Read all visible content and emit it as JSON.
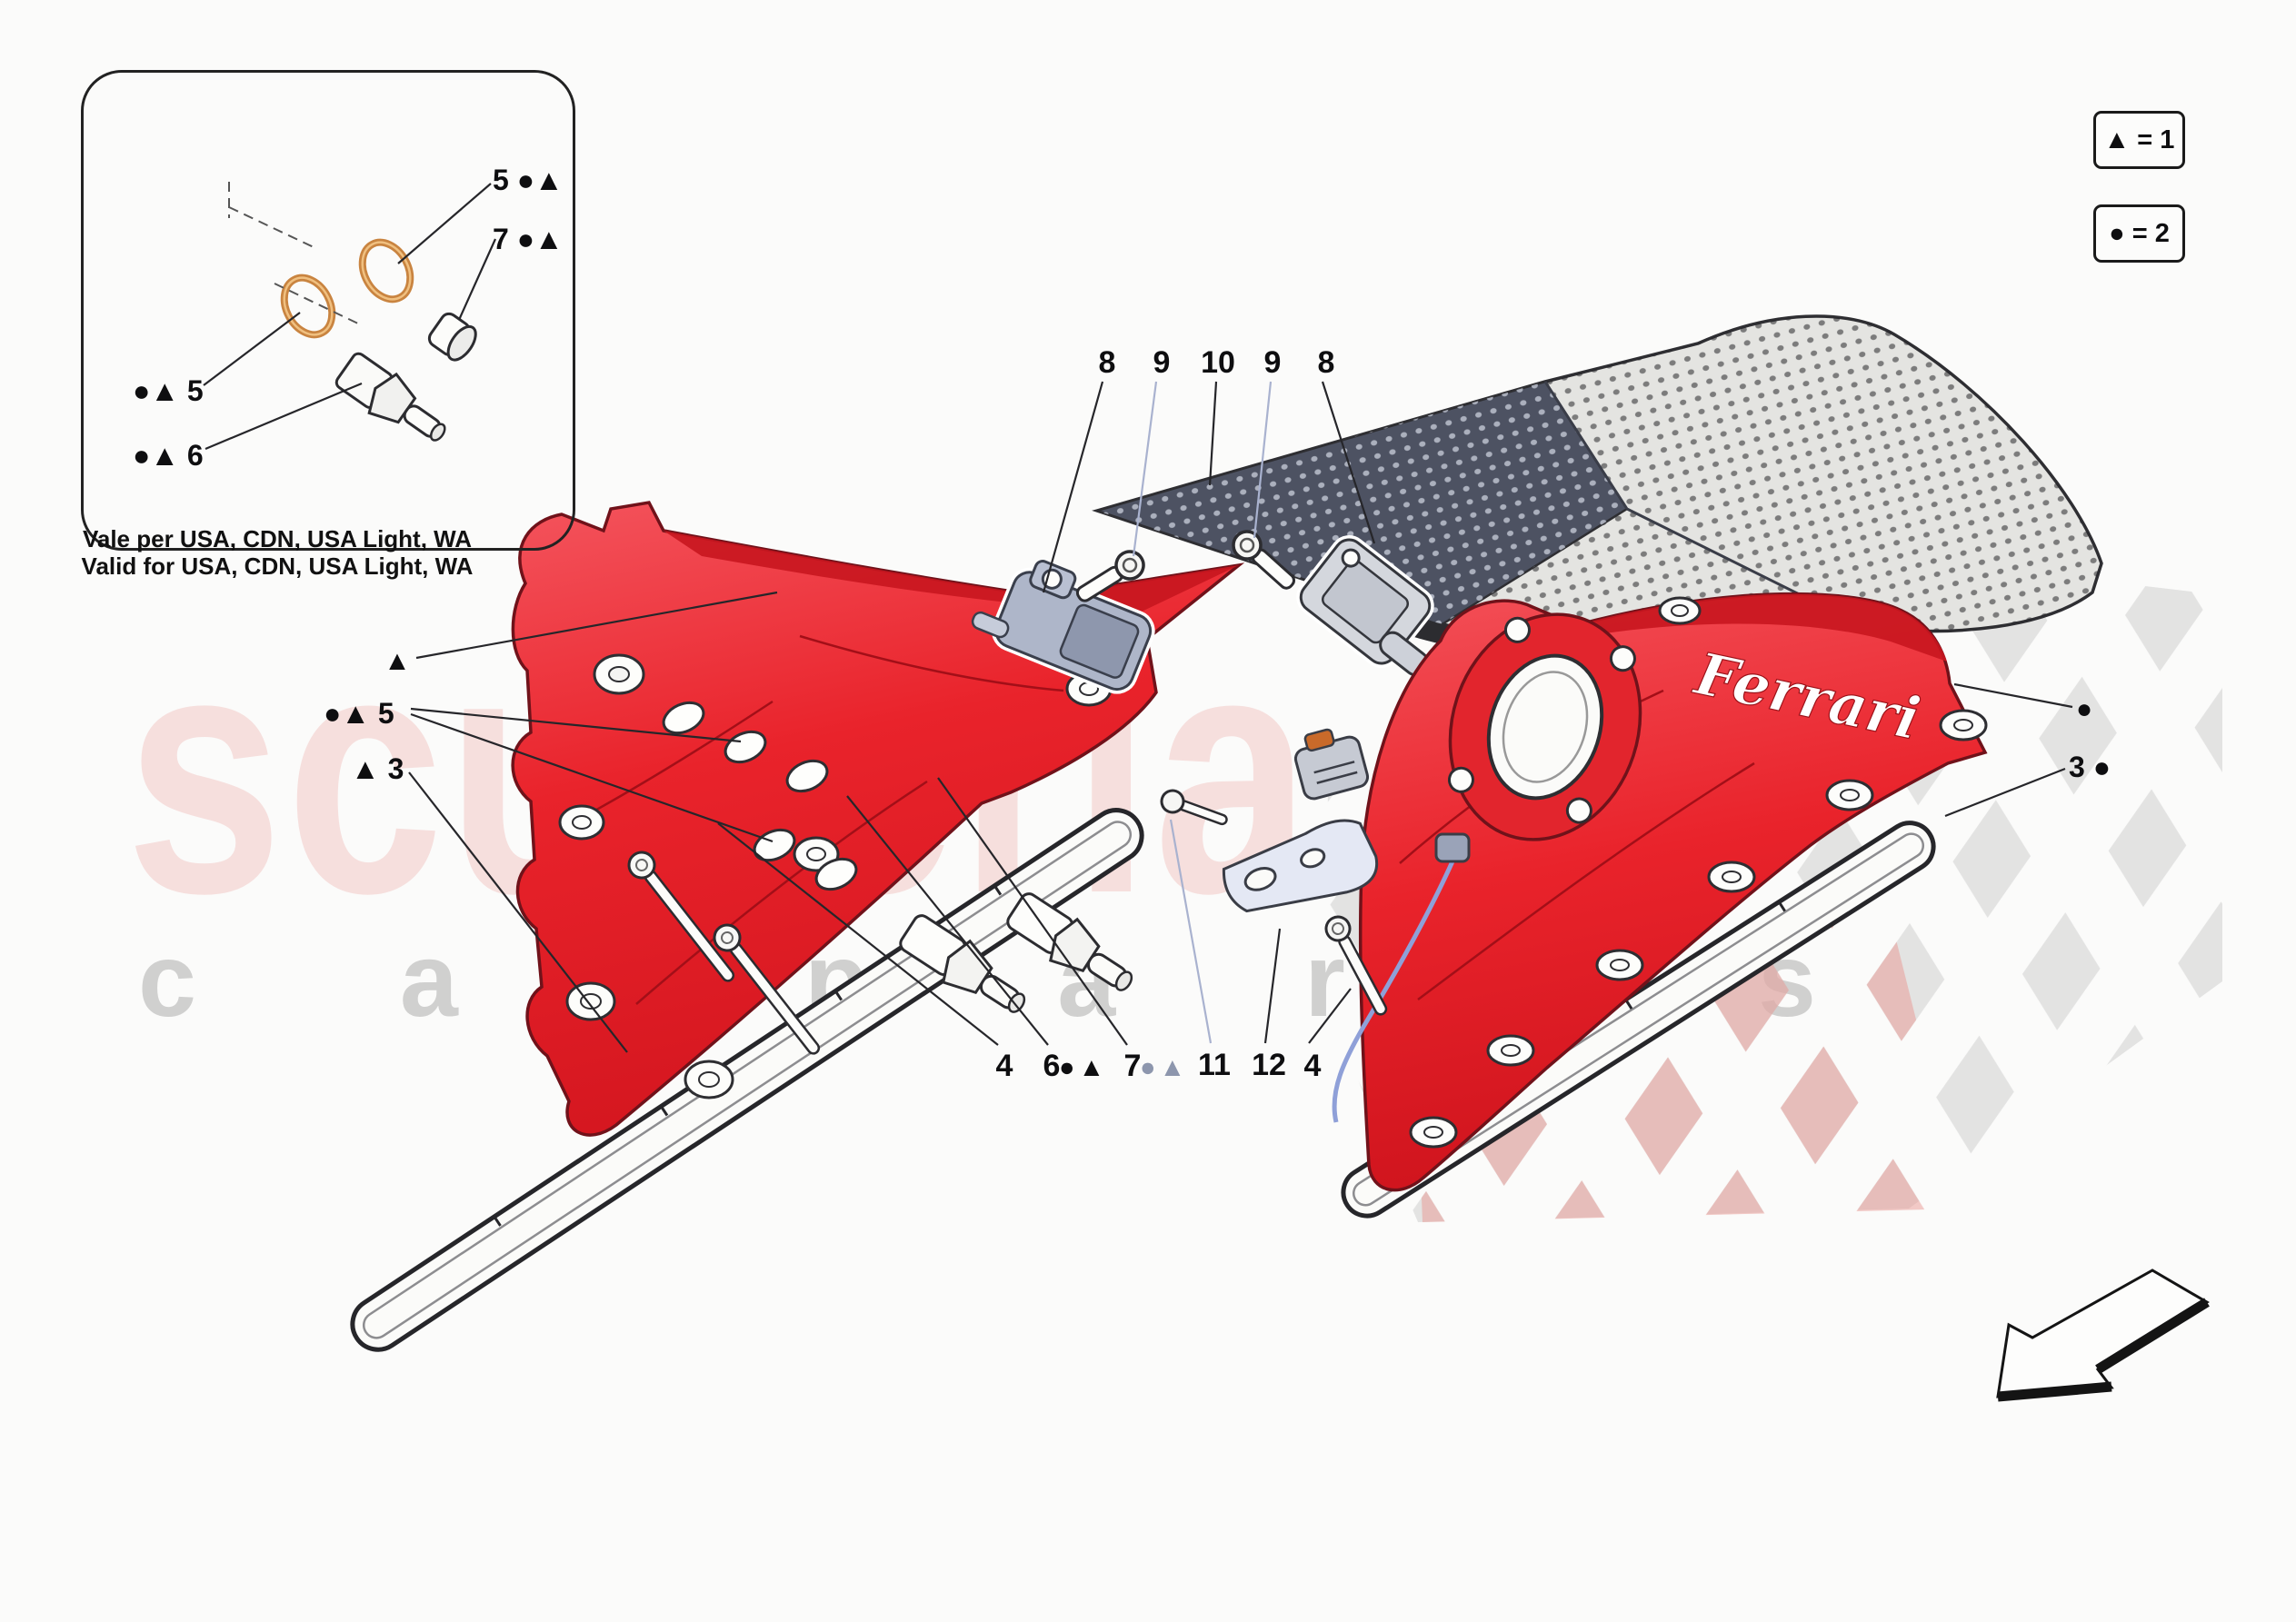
{
  "watermark": {
    "brand": "scuderia",
    "sub_left": "c a r",
    "sub_right": "p a r t s"
  },
  "legend": {
    "items": [
      {
        "label": "▲ = 1"
      },
      {
        "label": "● = 2"
      }
    ]
  },
  "inset": {
    "label_oring_top": "5 ●▲",
    "label_cap": "7 ●▲",
    "label_oring_left": "●▲ 5",
    "label_sensor": "●▲ 6",
    "note_line1": "Vale per USA, CDN, USA Light, WA",
    "note_line2": "Valid for USA, CDN, USA Light, WA"
  },
  "callouts": {
    "top": [
      "8",
      "9",
      "10",
      "9",
      "8"
    ],
    "left": {
      "cover_triangle": "▲",
      "washers": "●▲ 5",
      "gasket": "▲ 3"
    },
    "right": {
      "cover_circle": "●",
      "gasket": "3 ●"
    },
    "bottom": {
      "bolt_left": "4",
      "sensor_num": "6",
      "sensor_sym": "●▲",
      "cap_num": "7",
      "cap_sym": "●▲",
      "screw": "11",
      "bracket": "12",
      "bolt_right": "4"
    }
  },
  "cover_script": "Ferrari",
  "colors": {
    "cover_red": "#e9262e",
    "cover_red_dark": "#c8161f",
    "carbon_dark": "#4d5262",
    "carbon_light": "#e4e4e1",
    "copper": "#c98440",
    "leader_black": "#26262a",
    "leader_blue": "#a9b2cf",
    "watermark_pink": "rgba(224,78,72,0.16)",
    "watermark_gray": "rgba(118,118,118,0.32)"
  }
}
